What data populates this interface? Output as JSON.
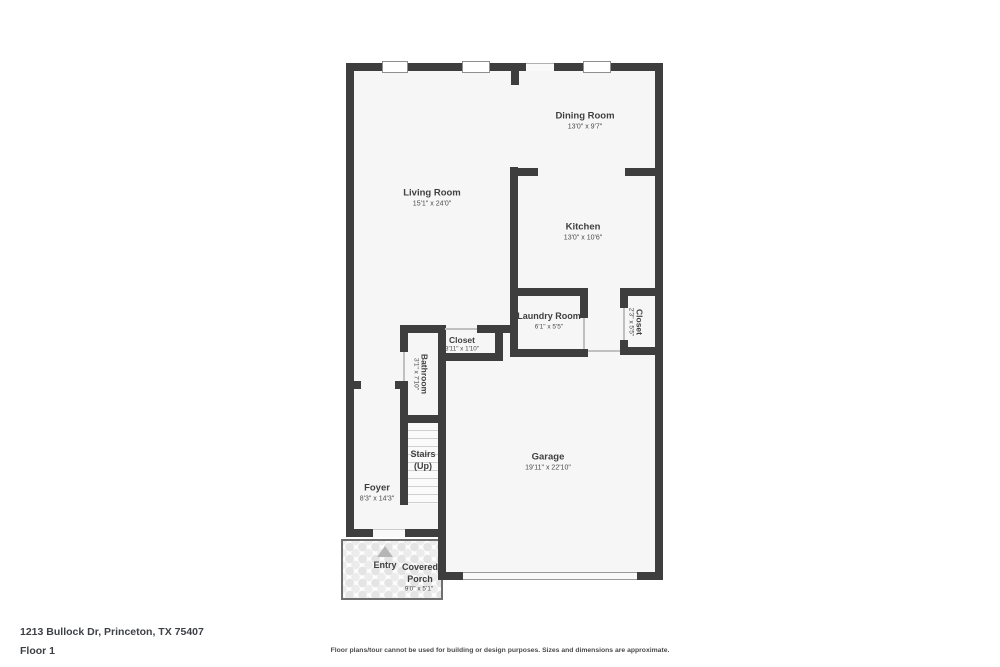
{
  "colors": {
    "wall": "#3e3e3e",
    "floor_fill": "#f6f6f6",
    "label_text": "#3f3f3f",
    "dims_text": "#4a4a4a",
    "window_border": "#8f8f8f",
    "stair_tread": "#cfcfcf",
    "porch_stone": "#e4e4e4",
    "entry_arrow": "#b5b5b5"
  },
  "rooms": {
    "dining": {
      "name": "Dining Room",
      "dims": "13'0\" x 9'7\""
    },
    "living": {
      "name": "Living Room",
      "dims": "15'1\" x 24'0\""
    },
    "kitchen": {
      "name": "Kitchen",
      "dims": "13'0\" x 10'6\""
    },
    "laundry": {
      "name": "Laundry Room",
      "dims": "6'1\" x 5'5\""
    },
    "closet_hall": {
      "name": "Closet",
      "dims": "3'11\" x 1'10\""
    },
    "closet_right": {
      "name": "Closet",
      "dims": "2'3\" x 5'5\""
    },
    "bathroom": {
      "name": "Bathroom",
      "dims": "3'1\" x 7'10\""
    },
    "stairs": {
      "name": "Stairs",
      "sub": "(Up)"
    },
    "foyer": {
      "name": "Foyer",
      "dims": "8'3\" x 14'3\""
    },
    "garage": {
      "name": "Garage",
      "dims": "19'11\" x 22'10\""
    },
    "entry": {
      "name": "Entry"
    },
    "porch": {
      "name_line1": "Covered",
      "name_line2": "Porch",
      "dims": "9'0\" x 5'1\""
    }
  },
  "footer": {
    "address": "1213 Bullock Dr, Princeton, TX 75407",
    "floor_label": "Floor 1",
    "disclaimer": "Floor plans/tour cannot be used for building or design purposes. Sizes and dimensions are approximate."
  }
}
